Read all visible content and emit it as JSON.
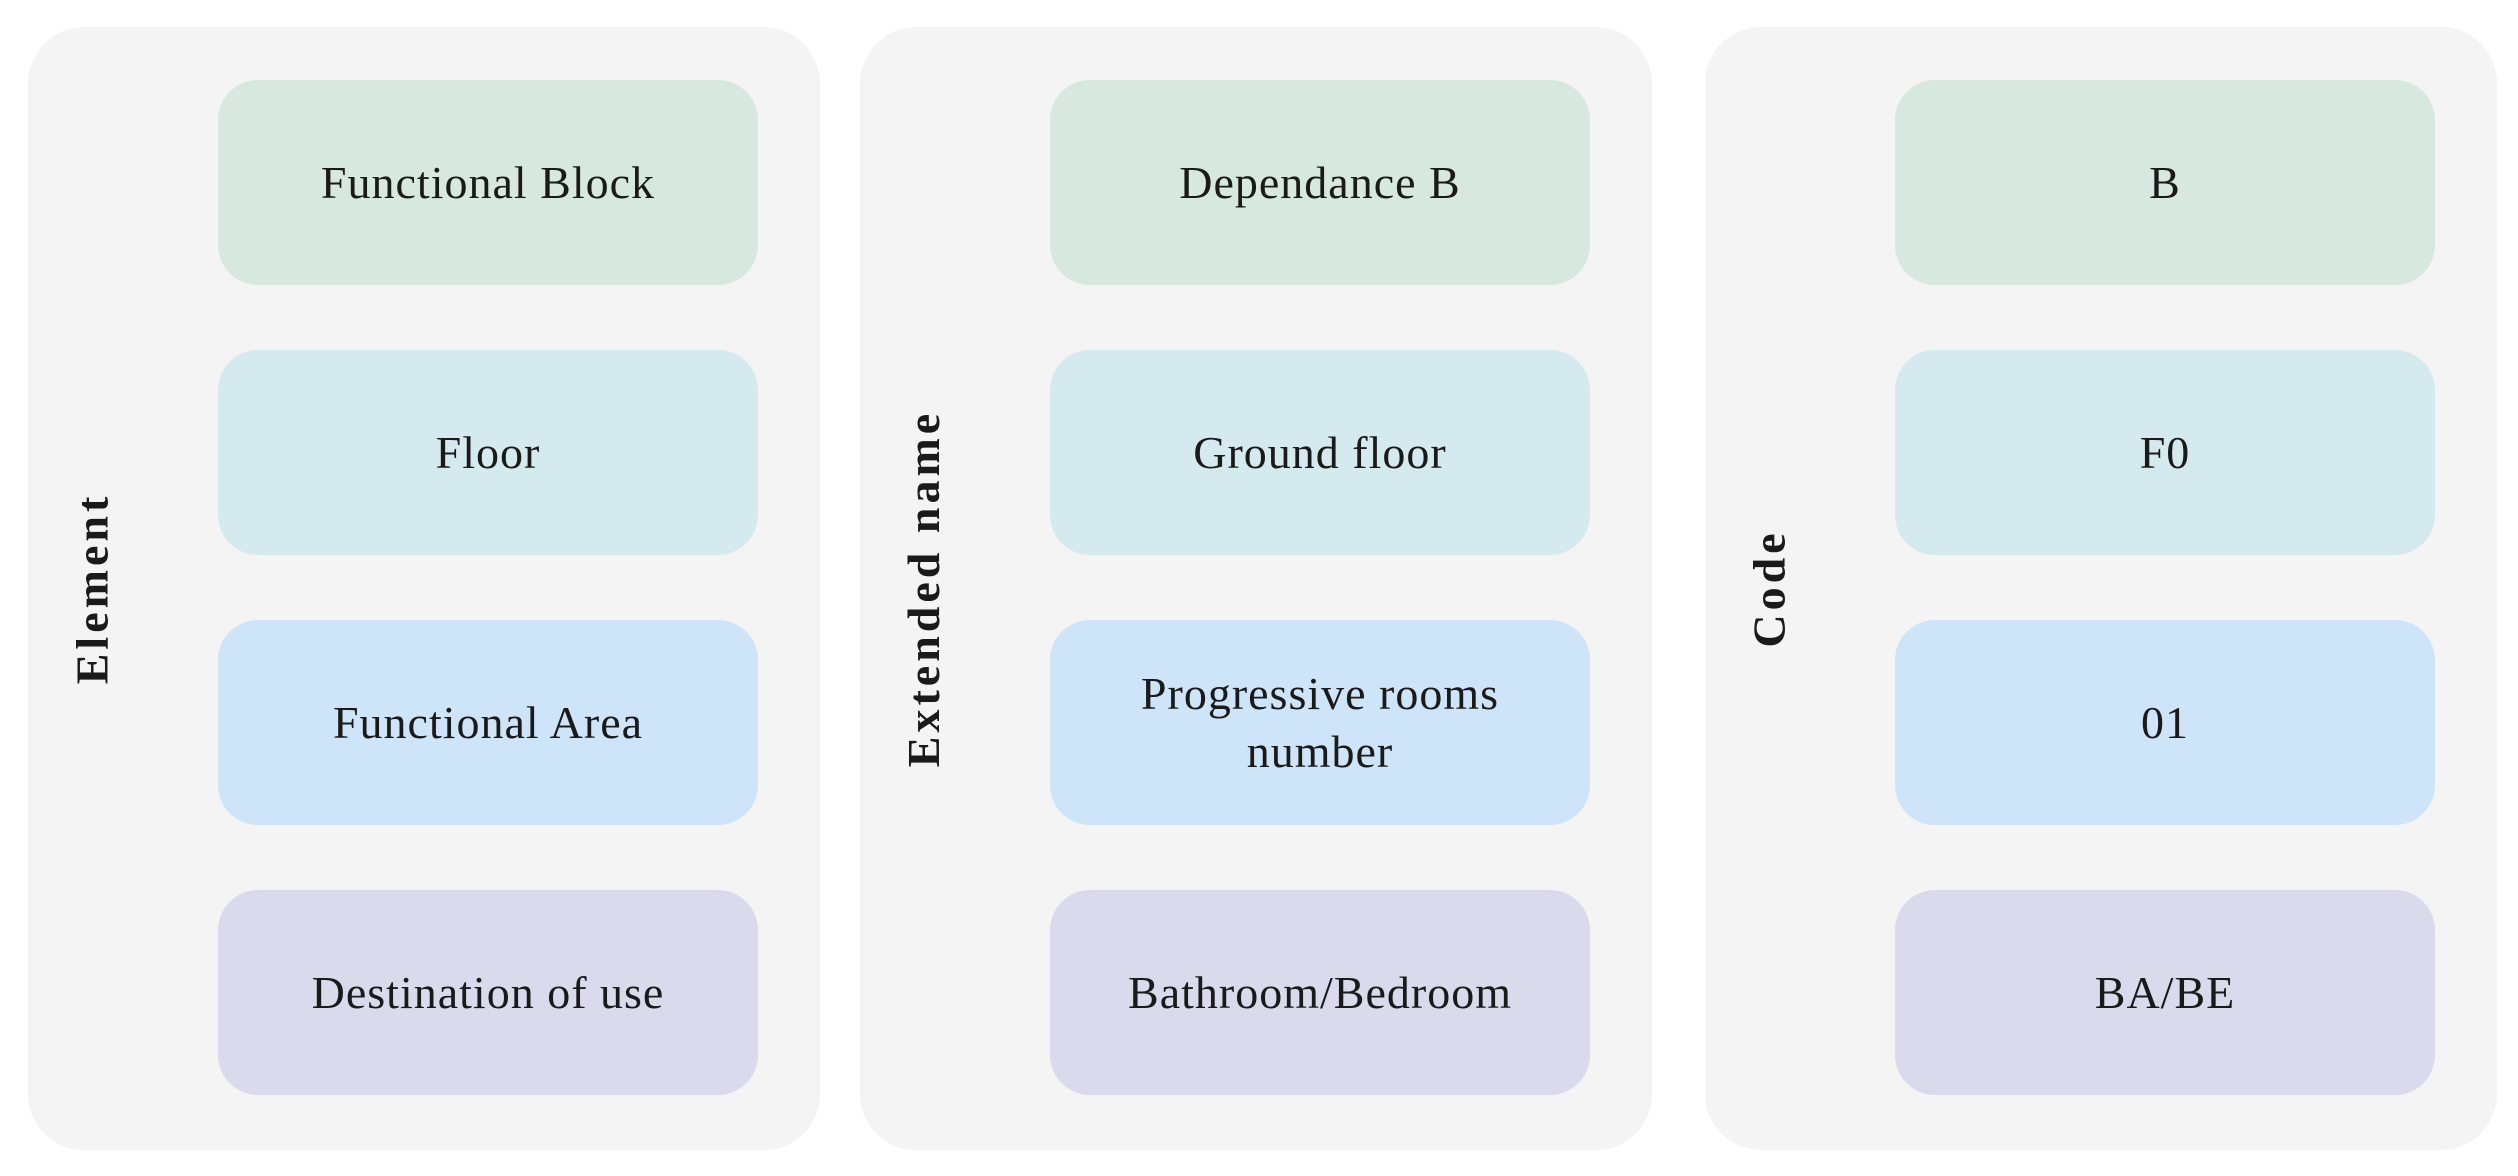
{
  "figure": {
    "panel_bg": "#f4f4f5",
    "text_color": "#1a1a1a",
    "row_colors": [
      "#d7e8e0",
      "#d5eaee",
      "#cee4f8",
      "#dbd9ec"
    ],
    "columns": [
      {
        "label": "Element",
        "cells": [
          "Functional Block",
          "Floor",
          "Functional Area",
          "Destination of use"
        ]
      },
      {
        "label": "Extended name",
        "cells": [
          "Dependance B",
          "Ground floor",
          "Progressive rooms number",
          "Bathroom/Bedroom"
        ]
      },
      {
        "label": "Code",
        "cells": [
          "B",
          "F0",
          "01",
          "BA/BE"
        ]
      }
    ]
  }
}
